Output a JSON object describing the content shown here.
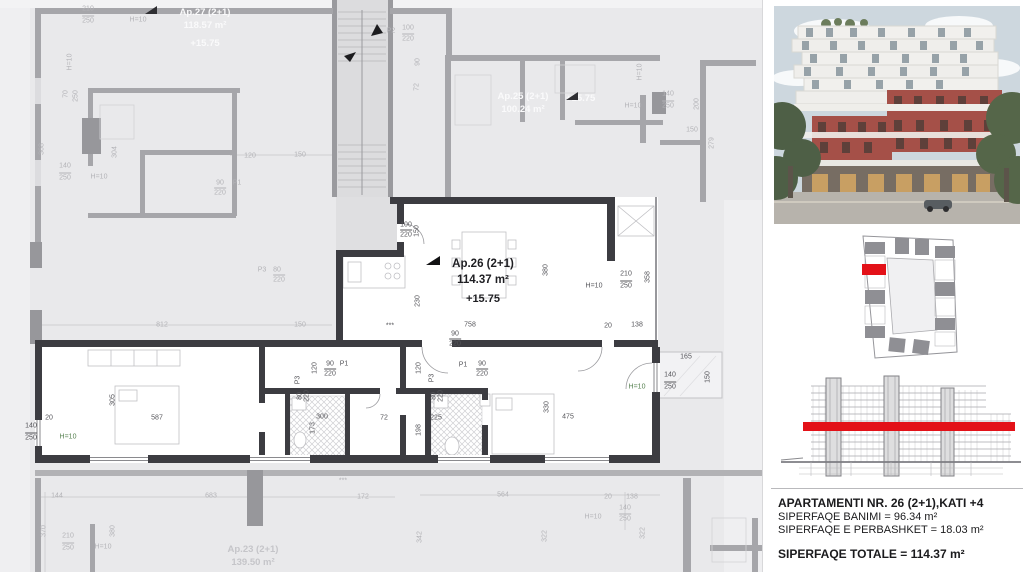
{
  "colors": {
    "highlight_red": "#e31118",
    "wall_dark": "#3c3c41",
    "wall_gray": "#a6a6aa",
    "plan_bg": "#e9e9eb",
    "dim_light": "#b3b3b7",
    "dim_dark": "#55555a",
    "dim_green": "#55804f"
  },
  "plan": {
    "apartments": [
      {
        "name": "Ap.27 (2+1)",
        "area": "118.57 m²",
        "level": "+15.75"
      },
      {
        "name": "Ap.25 (2+1)",
        "area": "100.24 m²",
        "level": "+15.75"
      },
      {
        "name": "Ap.26 (2+1)",
        "area": "114.37 m²",
        "level": "+15.75",
        "highlighted": true
      },
      {
        "name": "Ap.23 (2+1)",
        "area": "139.50 m²"
      }
    ],
    "annotations": [
      {
        "t": "210",
        "x": 88,
        "y": 9
      },
      {
        "t": "250",
        "x": 88,
        "y": 20,
        "c": "fb"
      },
      {
        "t": "H=10",
        "x": 138,
        "y": 20
      },
      {
        "t": "H=10",
        "x": 70,
        "y": 62,
        "c": "v"
      },
      {
        "t": "70",
        "x": 66,
        "y": 94,
        "c": "v"
      },
      {
        "t": "250",
        "x": 76,
        "y": 96,
        "c": "v"
      },
      {
        "t": "368",
        "x": 42,
        "y": 149,
        "c": "v"
      },
      {
        "t": "304",
        "x": 115,
        "y": 152,
        "c": "v"
      },
      {
        "t": "140",
        "x": 65,
        "y": 166
      },
      {
        "t": "250",
        "x": 65,
        "y": 177,
        "c": "fb"
      },
      {
        "t": "H=10",
        "x": 99,
        "y": 177
      },
      {
        "t": "P2",
        "x": 391,
        "y": 31
      },
      {
        "t": "100",
        "x": 408,
        "y": 28
      },
      {
        "t": "220",
        "x": 408,
        "y": 38,
        "c": "fb"
      },
      {
        "t": "90",
        "x": 418,
        "y": 62,
        "c": "v"
      },
      {
        "t": "72",
        "x": 417,
        "y": 87,
        "c": "v"
      },
      {
        "t": "120",
        "x": 250,
        "y": 156
      },
      {
        "t": "150",
        "x": 300,
        "y": 155
      },
      {
        "t": "90",
        "x": 220,
        "y": 183
      },
      {
        "t": "P1",
        "x": 237,
        "y": 183
      },
      {
        "t": "220",
        "x": 220,
        "y": 192,
        "c": "fb"
      },
      {
        "t": "P3",
        "x": 262,
        "y": 270
      },
      {
        "t": "80",
        "x": 277,
        "y": 270
      },
      {
        "t": "220",
        "x": 279,
        "y": 279,
        "c": "fb"
      },
      {
        "t": "812",
        "x": 162,
        "y": 325
      },
      {
        "t": "150",
        "x": 300,
        "y": 325
      },
      {
        "t": "H=10",
        "x": 640,
        "y": 72,
        "c": "v"
      },
      {
        "t": "140",
        "x": 668,
        "y": 94
      },
      {
        "t": "250",
        "x": 668,
        "y": 105,
        "c": "fb"
      },
      {
        "t": "H=10",
        "x": 633,
        "y": 106
      },
      {
        "t": "200",
        "x": 697,
        "y": 104,
        "c": "v"
      },
      {
        "t": "150",
        "x": 692,
        "y": 130
      },
      {
        "t": "279",
        "x": 712,
        "y": 143,
        "c": "v"
      },
      {
        "t": "144",
        "x": 57,
        "y": 496
      },
      {
        "t": "683",
        "x": 211,
        "y": 496
      },
      {
        "t": "172",
        "x": 363,
        "y": 497
      },
      {
        "t": "370",
        "x": 44,
        "y": 531,
        "c": "v"
      },
      {
        "t": "210",
        "x": 68,
        "y": 536
      },
      {
        "t": "250",
        "x": 68,
        "y": 547,
        "c": "fb"
      },
      {
        "t": "H=10",
        "x": 103,
        "y": 547
      },
      {
        "t": "380",
        "x": 113,
        "y": 531,
        "c": "v"
      },
      {
        "t": "***",
        "x": 343,
        "y": 481
      },
      {
        "t": "564",
        "x": 503,
        "y": 495
      },
      {
        "t": "20",
        "x": 608,
        "y": 497
      },
      {
        "t": "138",
        "x": 632,
        "y": 497
      },
      {
        "t": "140",
        "x": 625,
        "y": 508
      },
      {
        "t": "H=10",
        "x": 593,
        "y": 517
      },
      {
        "t": "250",
        "x": 625,
        "y": 518,
        "c": "fb"
      },
      {
        "t": "342",
        "x": 420,
        "y": 537,
        "c": "v"
      },
      {
        "t": "322",
        "x": 545,
        "y": 536,
        "c": "v"
      },
      {
        "t": "322",
        "x": 643,
        "y": 533,
        "c": "v"
      },
      {
        "t": "100",
        "x": 406,
        "y": 225,
        "c": "dk"
      },
      {
        "t": "220",
        "x": 406,
        "y": 234,
        "c": "dk fb"
      },
      {
        "t": "150",
        "x": 417,
        "y": 231,
        "c": "dk v"
      },
      {
        "t": "230",
        "x": 418,
        "y": 301,
        "c": "dk v"
      },
      {
        "t": "758",
        "x": 470,
        "y": 325,
        "c": "dk"
      },
      {
        "t": "90",
        "x": 455,
        "y": 334,
        "c": "dk"
      },
      {
        "t": "220",
        "x": 455,
        "y": 343,
        "c": "dk fb"
      },
      {
        "t": "380",
        "x": 546,
        "y": 270,
        "c": "dk v"
      },
      {
        "t": "H=10",
        "x": 594,
        "y": 286,
        "c": "dk"
      },
      {
        "t": "210",
        "x": 626,
        "y": 274,
        "c": "dk"
      },
      {
        "t": "250",
        "x": 626,
        "y": 285,
        "c": "dk fb"
      },
      {
        "t": "358",
        "x": 648,
        "y": 277,
        "c": "dk v"
      },
      {
        "t": "20",
        "x": 608,
        "y": 326,
        "c": "dk"
      },
      {
        "t": "138",
        "x": 637,
        "y": 325,
        "c": "dk"
      },
      {
        "t": "165",
        "x": 686,
        "y": 357,
        "c": "dk"
      },
      {
        "t": "140",
        "x": 670,
        "y": 375,
        "c": "dk"
      },
      {
        "t": "250",
        "x": 670,
        "y": 386,
        "c": "dk fb"
      },
      {
        "t": "H=10",
        "x": 637,
        "y": 387,
        "c": "gn"
      },
      {
        "t": "150",
        "x": 708,
        "y": 377,
        "c": "dk v"
      },
      {
        "t": "305",
        "x": 113,
        "y": 400,
        "c": "dk v"
      },
      {
        "t": "587",
        "x": 157,
        "y": 418,
        "c": "dk"
      },
      {
        "t": "20",
        "x": 49,
        "y": 418,
        "c": "dk"
      },
      {
        "t": "140",
        "x": 31,
        "y": 426,
        "c": "dk"
      },
      {
        "t": "250",
        "x": 31,
        "y": 437,
        "c": "dk fb"
      },
      {
        "t": "H=10",
        "x": 68,
        "y": 437,
        "c": "gn"
      },
      {
        "t": "120",
        "x": 315,
        "y": 368,
        "c": "dk v"
      },
      {
        "t": "90",
        "x": 330,
        "y": 364,
        "c": "dk"
      },
      {
        "t": "P1",
        "x": 344,
        "y": 364,
        "c": "dk"
      },
      {
        "t": "220",
        "x": 330,
        "y": 373,
        "c": "dk fb"
      },
      {
        "t": "P3",
        "x": 298,
        "y": 380,
        "c": "dk v"
      },
      {
        "t": "80",
        "x": 300,
        "y": 396,
        "c": "dk v"
      },
      {
        "t": "220",
        "x": 307,
        "y": 396,
        "c": "dk v"
      },
      {
        "t": "300",
        "x": 322,
        "y": 417,
        "c": "dk"
      },
      {
        "t": "173",
        "x": 313,
        "y": 428,
        "c": "dk v"
      },
      {
        "t": "72",
        "x": 384,
        "y": 418,
        "c": "dk"
      },
      {
        "t": "120",
        "x": 419,
        "y": 368,
        "c": "dk v"
      },
      {
        "t": "P3",
        "x": 432,
        "y": 378,
        "c": "dk v"
      },
      {
        "t": "80",
        "x": 434,
        "y": 396,
        "c": "dk v"
      },
      {
        "t": "220",
        "x": 441,
        "y": 396,
        "c": "dk v"
      },
      {
        "t": "P1",
        "x": 463,
        "y": 365,
        "c": "dk"
      },
      {
        "t": "90",
        "x": 482,
        "y": 364,
        "c": "dk"
      },
      {
        "t": "220",
        "x": 482,
        "y": 373,
        "c": "dk fb"
      },
      {
        "t": "225",
        "x": 436,
        "y": 418,
        "c": "dk"
      },
      {
        "t": "198",
        "x": 419,
        "y": 430,
        "c": "dk v"
      },
      {
        "t": "330",
        "x": 547,
        "y": 407,
        "c": "dk v"
      },
      {
        "t": "475",
        "x": 568,
        "y": 417,
        "c": "dk"
      },
      {
        "t": "***",
        "x": 390,
        "y": 326,
        "c": "dk"
      }
    ]
  },
  "right_panel": {
    "info": {
      "title": "APARTAMENTI NR. 26 (2+1),KATI +4",
      "line_banimi": "SIPERFAQE BANIMI = 96.34 m²",
      "line_perbashket": "SIPERFAQE E PERBASHKET = 18.03 m²",
      "line_totale": "SIPERFAQE TOTALE = 114.37 m²"
    }
  }
}
